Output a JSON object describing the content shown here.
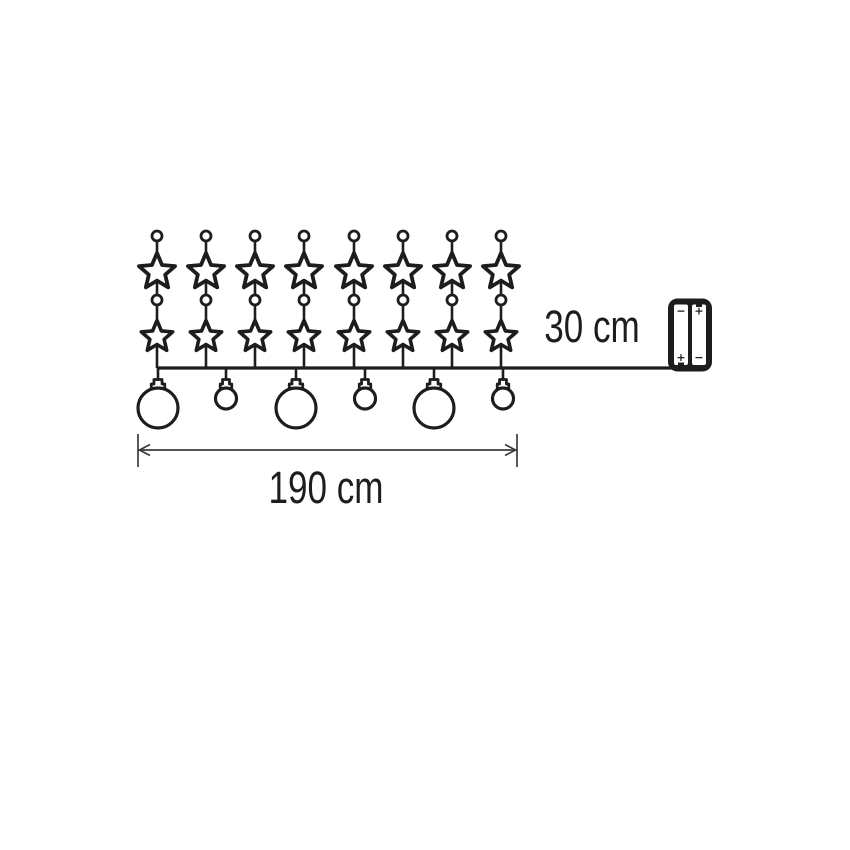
{
  "colors": {
    "background": "#ffffff",
    "ink": "#1d1d1b",
    "dimension_ink": "#3c3c3c"
  },
  "labels": {
    "garland_length": "190 cm",
    "lead_length": "30 cm"
  },
  "battery_box": {
    "left_battery": {
      "top_sign": "−",
      "bottom_sign": "+"
    },
    "right_battery": {
      "top_sign": "+",
      "bottom_sign": "−"
    }
  },
  "diagram": {
    "string_xs": [
      157,
      206,
      255,
      304,
      354,
      403,
      452,
      501
    ],
    "string": {
      "top_dot_y": 236,
      "mid_dot_y": 300,
      "dot_radius": 5,
      "star1_y": 272,
      "star1_outer_r": 19,
      "star1_inner_r": 8.6,
      "star2_y": 337,
      "star2_outer_r": 16.5,
      "star2_inner_r": 7.5
    },
    "wire": {
      "y": 368,
      "x_start": 157,
      "x_end": 672
    },
    "balls": [
      {
        "x": 158,
        "size": "large"
      },
      {
        "x": 226,
        "size": "small"
      },
      {
        "x": 296,
        "size": "large"
      },
      {
        "x": 365,
        "size": "small"
      },
      {
        "x": 434,
        "size": "large"
      },
      {
        "x": 503,
        "size": "small"
      }
    ],
    "ball_large_r": 20,
    "ball_small_r": 10.5,
    "cap_top_y": 379.5,
    "battery": {
      "x": 668,
      "y": 298.5,
      "w": 44,
      "h": 73,
      "rx": 9.5,
      "cell_w": 14,
      "cell_h": 60.5,
      "left_cell_x": 674,
      "right_cell_x": 692,
      "cell_y": 304.5
    },
    "dimension": {
      "y": 450,
      "x1": 138,
      "x2": 517,
      "tick_top": 434,
      "tick_bottom": 467,
      "label_x": 326,
      "label_y": 503
    },
    "lead_label": {
      "x": 592,
      "y": 342
    }
  }
}
